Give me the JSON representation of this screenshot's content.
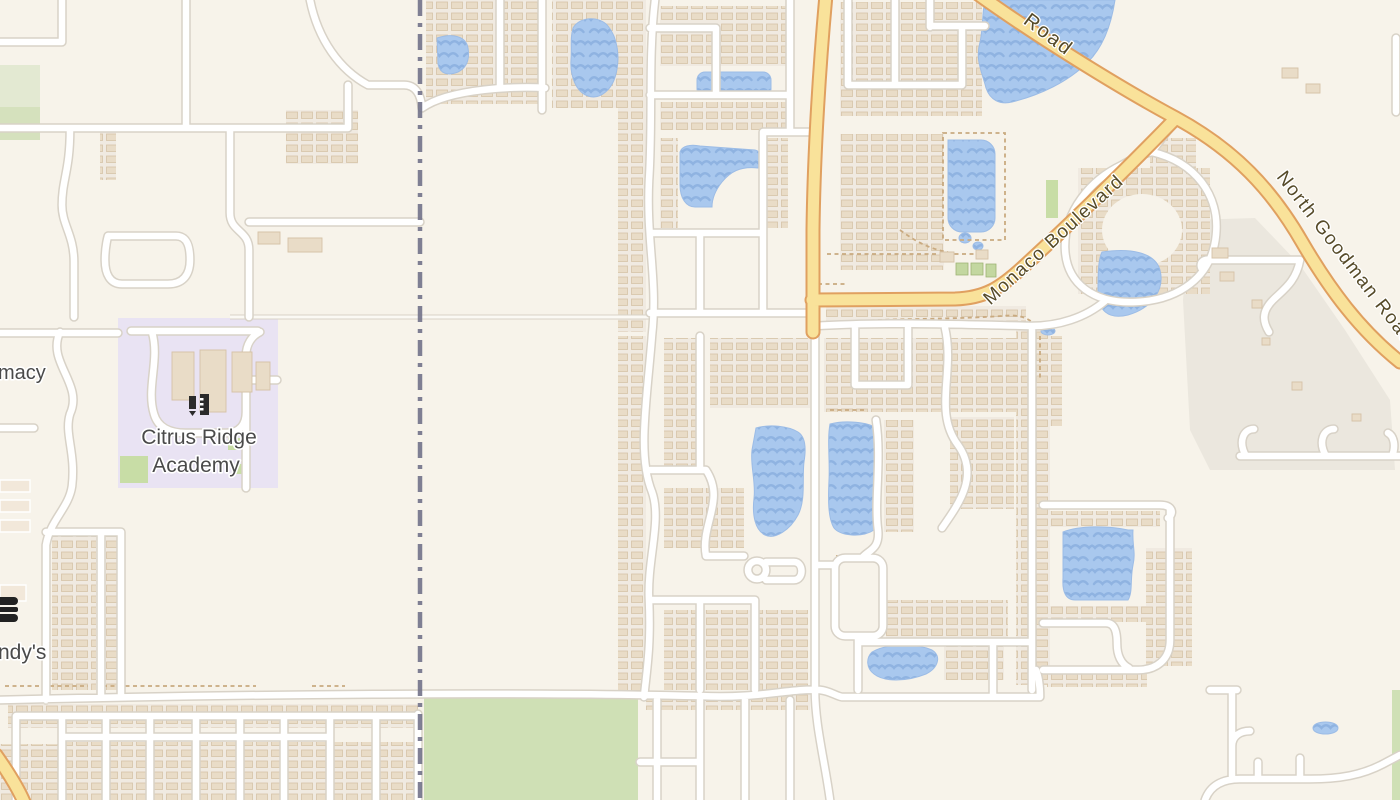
{
  "map": {
    "labels": {
      "road_partial": "Road",
      "monaco_boulevard": "Monaco Boulevard",
      "north_goodman_road": "North Goodman Road",
      "school_line1": "Citrus Ridge",
      "school_line2": "Academy",
      "pharmacy_partial": "macy",
      "wendys_partial": "ndy's"
    },
    "icons": {
      "school": "school-icon",
      "restaurant": "burger-icon"
    },
    "colors": {
      "background": "#f7f3ea",
      "residential_block": "#f0eae1",
      "building": "#e9dcc7",
      "building_outline": "#d6c3a8",
      "water": "#a9c8ee",
      "water_wave": "#8fb3e1",
      "road_fill": "#ffffff",
      "road_casing": "#d8d2c7",
      "primary_road_fill": "#f9e29a",
      "primary_road_casing": "#e0a060",
      "boundary_line": "#73738a",
      "school_area": "#e9e3f3",
      "park": "#cfe0b5",
      "industrial_area": "#ebe7de",
      "scrub_green": "#dde5c8",
      "poi_label": "#4a4a4a",
      "road_label": "#554a28"
    }
  }
}
